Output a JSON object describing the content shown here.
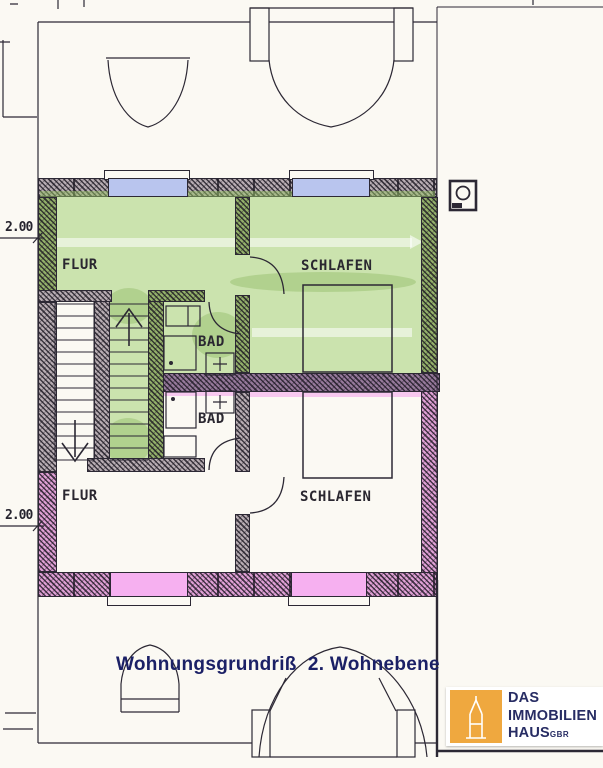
{
  "title": {
    "text": "Wohnungsgrundriß  2. Wohnebene"
  },
  "dimensions": [
    {
      "label": "2.00"
    },
    {
      "label": "2.00"
    }
  ],
  "rooms": [
    {
      "id": "flur-upper",
      "label": "FLUR"
    },
    {
      "id": "schlafen-upper",
      "label": "SCHLAFEN"
    },
    {
      "id": "bad-upper",
      "label": "BAD"
    },
    {
      "id": "bad-lower",
      "label": "BAD"
    },
    {
      "id": "flur-lower",
      "label": "FLUR"
    },
    {
      "id": "schlafen-lower",
      "label": "SCHLAFEN"
    }
  ],
  "logo": {
    "line1": "DAS",
    "line2": "IMMOBILIEN",
    "line3": "HAUS",
    "suffix": "GBR"
  },
  "icons": {
    "chimney": "chimney-icon",
    "tower": "church-tower-icon",
    "stairs_up": "arrow-up",
    "stairs_down": "arrow-down"
  },
  "colors": {
    "highlight_green": "#cbe3ae",
    "highlight_pink": "#dfa0d5",
    "window_blue": "#b9c5ee",
    "window_pink": "#f6b0f0",
    "ink": "#2c2834",
    "title_navy": "#1b2066",
    "logo_orange": "#efa83f",
    "logo_navy": "#272c63"
  }
}
